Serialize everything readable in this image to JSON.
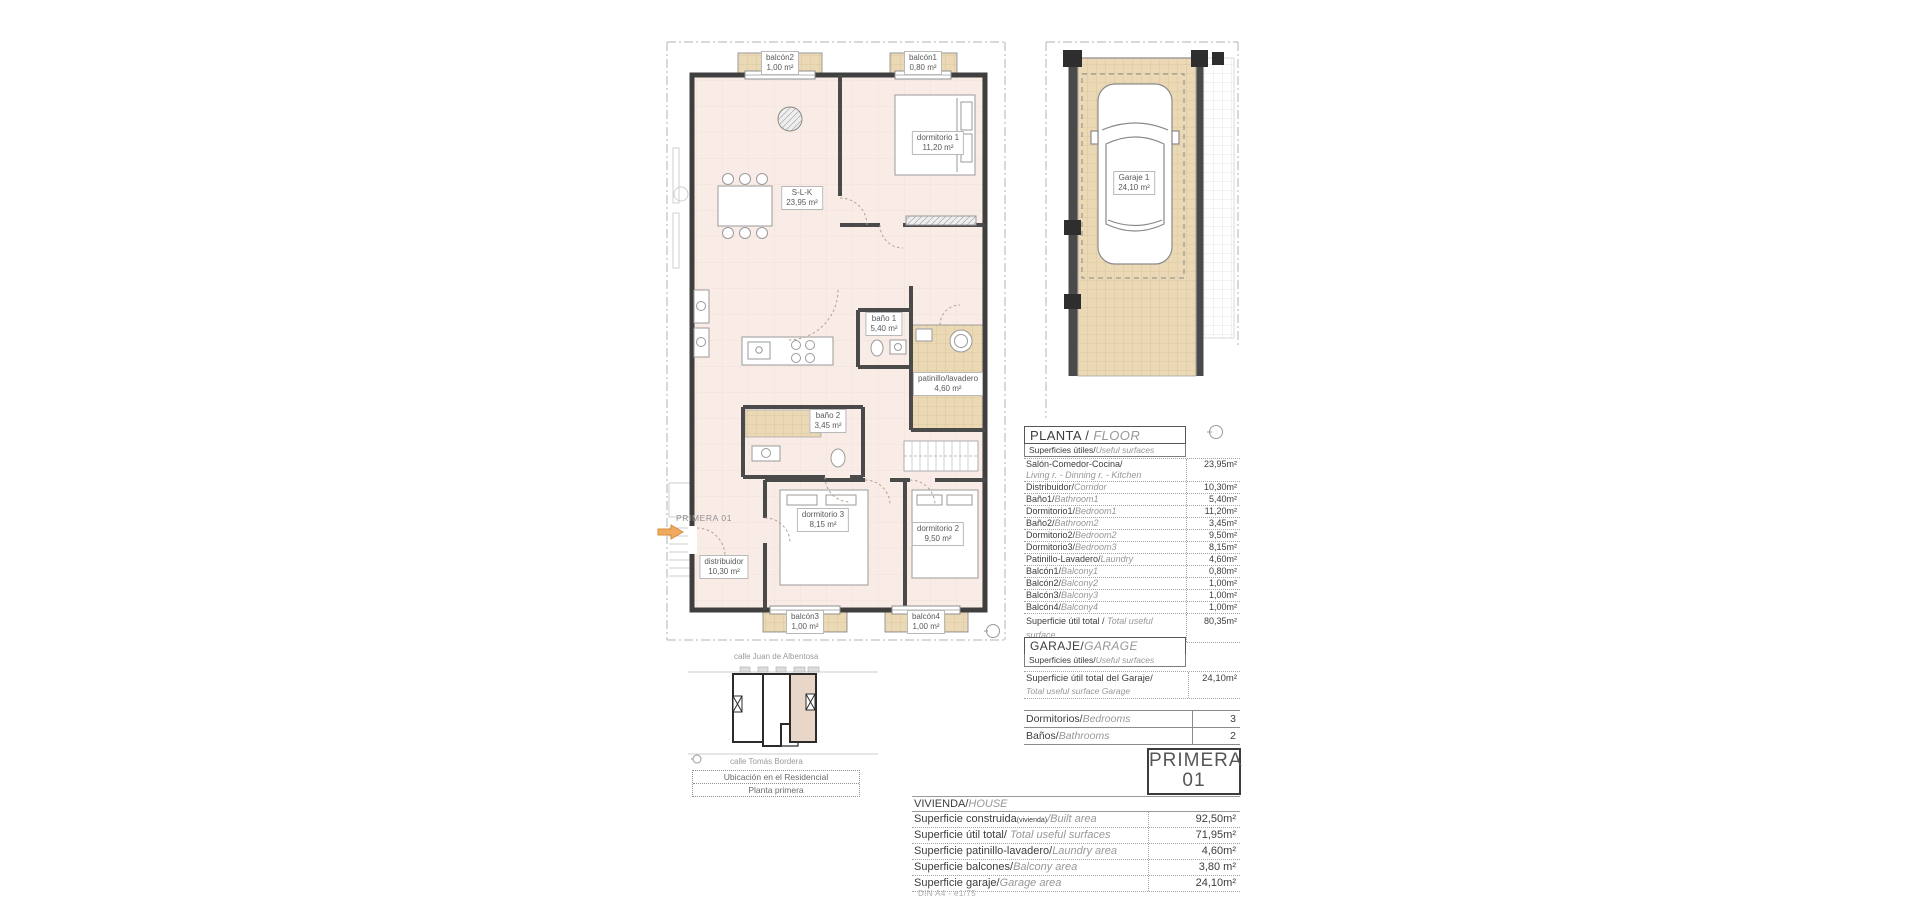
{
  "plan": {
    "unit_arrow_label": "PRIMERA 01",
    "labels": {
      "balcon2": {
        "name": "balcón2",
        "area": "1,00 m²"
      },
      "balcon1": {
        "name": "balcón1",
        "area": "0,80 m²"
      },
      "dormitorio1": {
        "name": "dormitorio 1",
        "area": "11,20 m²"
      },
      "slk": {
        "name": "S-L-K",
        "area": "23,95 m²"
      },
      "bano1": {
        "name": "baño 1",
        "area": "5,40 m²"
      },
      "patinillo": {
        "name": "patinillo/lavadero",
        "area": "4,60 m²"
      },
      "bano2": {
        "name": "baño 2",
        "area": "3,45 m²"
      },
      "dormitorio3": {
        "name": "dormitorio 3",
        "area": "8,15 m²"
      },
      "dormitorio2": {
        "name": "dormitorio 2",
        "area": "9,50 m²"
      },
      "distribuidor": {
        "name": "distribuidor",
        "area": "10,30 m²"
      },
      "balcon3": {
        "name": "balcón3",
        "area": "1,00 m²"
      },
      "balcon4": {
        "name": "balcón4",
        "area": "1,00 m²"
      }
    }
  },
  "garage_plan": {
    "label": {
      "name": "Garaje 1",
      "area": "24,10 m²"
    }
  },
  "floor_table": {
    "title_es": "PLANTA / ",
    "title_en": "FLOOR",
    "subtitle_es": "Superficies útiles/",
    "subtitle_en": "Useful surfaces",
    "rows": [
      {
        "es": "Salón-Comedor-Cocina/",
        "en": "Living r. - Dinning r. - Kitchen",
        "value": "23,95m²"
      },
      {
        "es": "Distribuidor/",
        "en": "Corridor",
        "value": "10,30m²"
      },
      {
        "es": "Baño1/",
        "en": "Bathroom1",
        "value": "5,40m²"
      },
      {
        "es": "Dormitorio1/",
        "en": "Bedroom1",
        "value": "11,20m²"
      },
      {
        "es": "Baño2/",
        "en": "Bathroom2",
        "value": "3,45m²"
      },
      {
        "es": "Dormitorio2/",
        "en": "Bedroom2",
        "value": "9,50m²"
      },
      {
        "es": "Dormitorio3/",
        "en": "Bedroom3",
        "value": "8,15m²"
      },
      {
        "es": "Patinillo-Lavadero/",
        "en": "Laundry",
        "value": "4,60m²"
      },
      {
        "es": "Balcón1/",
        "en": "Balcony1",
        "value": "0,80m²"
      },
      {
        "es": "Balcón2/",
        "en": "Balcony2",
        "value": "1,00m²"
      },
      {
        "es": "Balcón3/",
        "en": "Balcony3",
        "value": "1,00m²"
      },
      {
        "es": "Balcón4/",
        "en": "Balcony4",
        "value": "1,00m²"
      }
    ],
    "total": {
      "es": "Superficie útil total / ",
      "en": "Total useful surface",
      "value": "80,35m²"
    }
  },
  "garage_table": {
    "title_es": "GARAJE/",
    "title_en": "GARAGE",
    "subtitle_es": "Superficies útiles/",
    "subtitle_en": "Useful surfaces",
    "row": {
      "es": "Superficie útil total del Garaje/",
      "en": "Total useful surface Garage",
      "value": "24,10m²"
    }
  },
  "counts": {
    "rows": [
      {
        "es": "Dormitorios/",
        "en": "Bedrooms",
        "value": "3"
      },
      {
        "es": "Baños/",
        "en": "Bathrooms",
        "value": "2"
      }
    ]
  },
  "unit_badge": {
    "line1": "PRIMERA",
    "line2": "01"
  },
  "house_table": {
    "title_es": "VIVIENDA/",
    "title_en": "HOUSE",
    "rows": [
      {
        "es": "Superficie construida",
        "sub": "(vivienda)",
        "en": "/Built area",
        "value": "92,50m²"
      },
      {
        "es": "Superficie útil total/",
        "en": " Total useful surfaces",
        "value": "71,95m²"
      },
      {
        "es": "Superficie patinillo-lavadero/",
        "en": "Laundry area",
        "value": "4,60m²"
      },
      {
        "es": "Superficie balcones/",
        "en": "Balcony area",
        "value": "3,80 m²"
      },
      {
        "es": "Superficie garaje/",
        "en": "Garage area",
        "value": "24,10m²"
      }
    ]
  },
  "locator": {
    "street_top": "calle Juan de Albentosa",
    "street_bottom": "calle Tomás Bordera",
    "caption1": "Ubicación en el Residencial",
    "caption2": "Planta primera"
  },
  "scale_note": "DIN A4 - e1/75",
  "colors": {
    "tan": "#ebd9b6",
    "pink": "#f9ece7",
    "wall": "#3f3f3f",
    "arrow_orange": "#f0a95e"
  }
}
